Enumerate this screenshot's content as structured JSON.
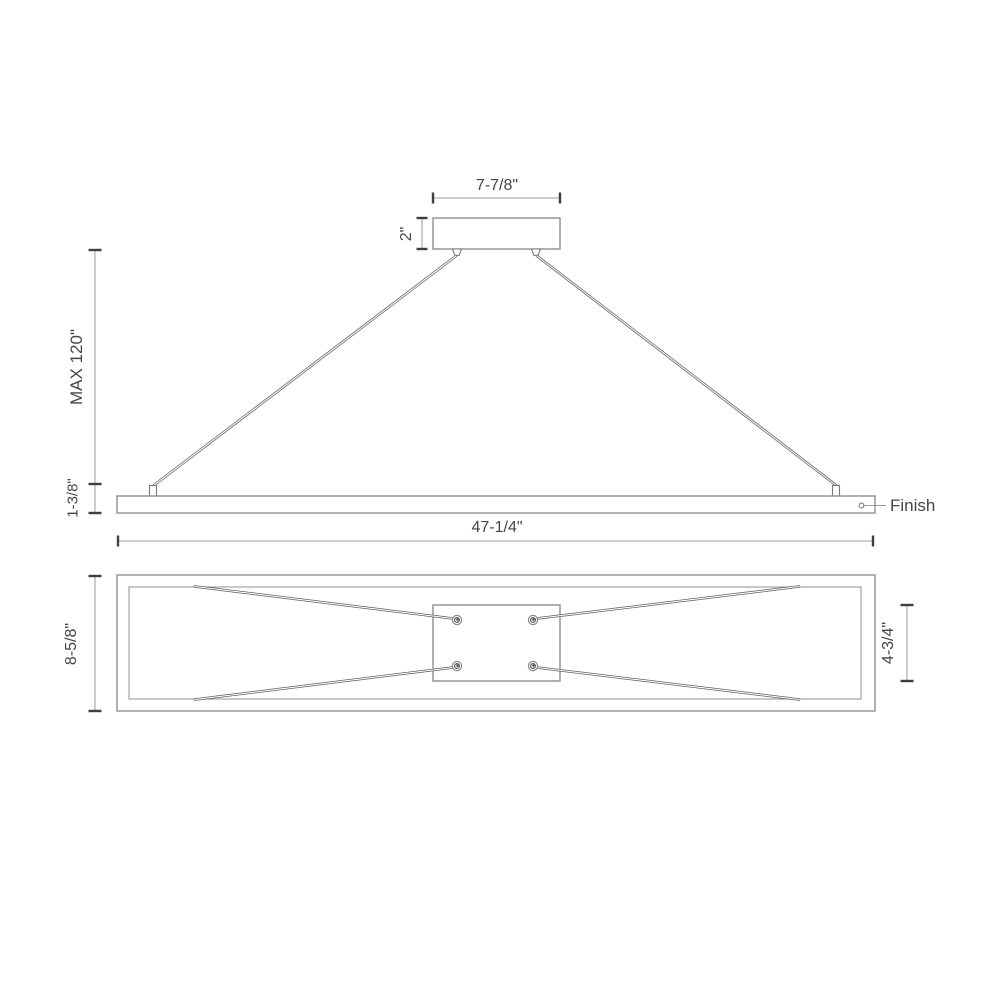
{
  "drawing": {
    "side_view": {
      "canopy_width": "7-7/8\"",
      "canopy_height": "2\"",
      "max_suspension": "MAX 120\"",
      "fixture_height": "1-3/8\"",
      "fixture_length": "47-1/4\"",
      "finish_callout": "Finish"
    },
    "bottom_view": {
      "fixture_depth": "8-5/8\"",
      "canopy_plate_height": "4-3/4\""
    },
    "colors": {
      "line": "#8f8f8f",
      "cable": "#5f5f5f",
      "dim_tick": "#3f3f3f",
      "text": "#454545",
      "background": "#ffffff"
    }
  }
}
